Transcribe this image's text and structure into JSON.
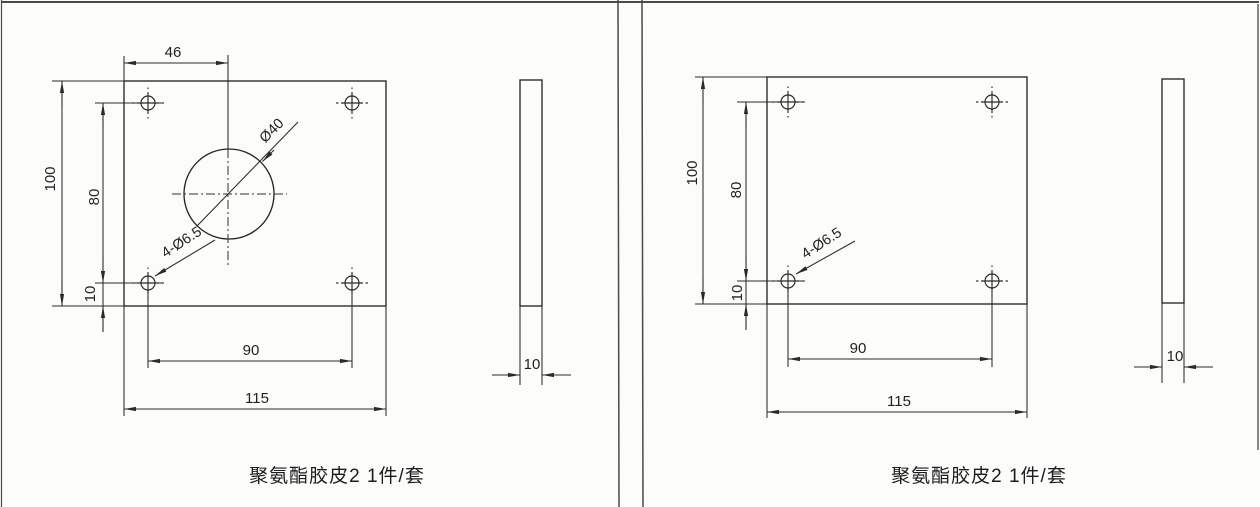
{
  "page": {
    "background": "#fcfcfb",
    "line_color": "#2a2a2a"
  },
  "left_drawing": {
    "caption": "聚氨酯胶皮2 1件/套",
    "front_view": {
      "dim_top_width": "46",
      "dim_height": "100",
      "dim_hole_spacing_vertical": "80",
      "dim_bottom_margin": "10",
      "dim_hole_spacing_horizontal": "90",
      "dim_width": "115",
      "hole_callout": "4-Ø6.5",
      "center_hole_callout": "Ø40"
    },
    "side_view": {
      "dim_thickness": "10"
    }
  },
  "right_drawing": {
    "caption": "聚氨酯胶皮2 1件/套",
    "front_view": {
      "dim_height": "100",
      "dim_hole_spacing_vertical": "80",
      "dim_bottom_margin": "10",
      "dim_hole_spacing_horizontal": "90",
      "dim_width": "115",
      "hole_callout": "4-Ø6.5"
    },
    "side_view": {
      "dim_thickness": "10"
    }
  }
}
